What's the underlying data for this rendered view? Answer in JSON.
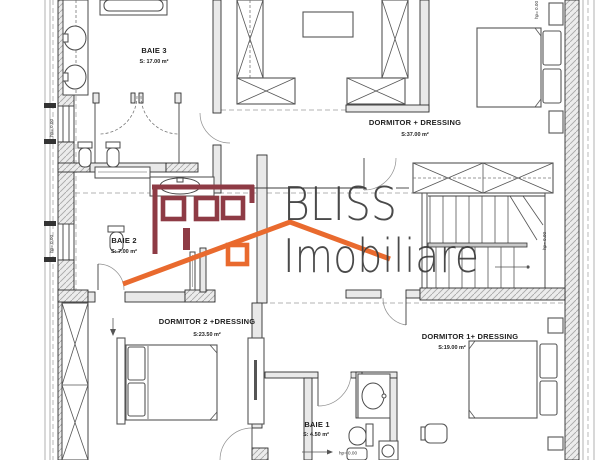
{
  "watermark": {
    "line1": "BLISS",
    "line2": "Imobiliare",
    "colors": {
      "text": "#3b3b3b",
      "maroon": "#8e3b45",
      "orange": "#e96a2e"
    }
  },
  "rooms": [
    {
      "id": "baie-3",
      "name": "BAIE 3",
      "area": "S: 17.00 m²"
    },
    {
      "id": "dormitor-dressing",
      "name": "DORMITOR + DRESSING",
      "area": "S:37.00 m²"
    },
    {
      "id": "baie-2",
      "name": "BAIE 2",
      "area": "S: 7.00 m²"
    },
    {
      "id": "dormitor-2",
      "name": "DORMITOR 2 +DRESSING",
      "area": "S:23.50 m²"
    },
    {
      "id": "dormitor-1",
      "name": "DORMITOR 1+ DRESSING",
      "area": "S:19.00 m²"
    },
    {
      "id": "baie-1",
      "name": "BAIE 1",
      "area": "S: 4.50 m²"
    }
  ],
  "annotations": {
    "level_mark": "hp= 0.00"
  }
}
